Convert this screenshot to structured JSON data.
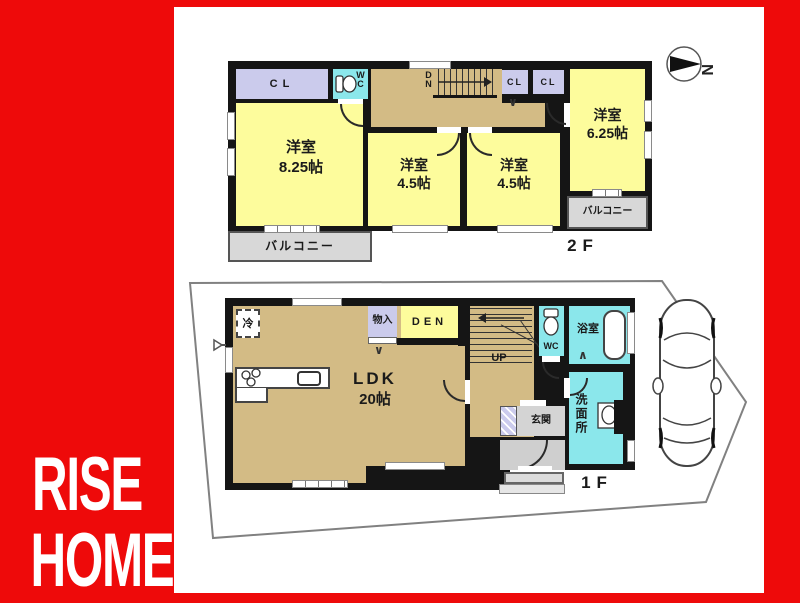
{
  "brand": {
    "line1": "RISE",
    "line2": "HOME",
    "bg_color": "#ee0a0a",
    "text_color": "#ffffff"
  },
  "compass": {
    "north_label": "N"
  },
  "colors": {
    "room_yellow": "#fdfc9c",
    "corridor_tan": "#d3bb85",
    "wet_cyan": "#8be7eb",
    "closet_lavender": "#cbcbec",
    "balcony_gray": "#d8d8d8",
    "wall_black": "#151515"
  },
  "floor2": {
    "label": "2F",
    "closet_left": "CL",
    "closet_mid": "CL",
    "closet_right": "CL",
    "wc": "WC",
    "stairs_down": "DN",
    "room_large": {
      "name": "洋室",
      "size": "8.25帖"
    },
    "room_mid_left": {
      "name": "洋室",
      "size": "4.5帖"
    },
    "room_mid_right": {
      "name": "洋室",
      "size": "4.5帖"
    },
    "room_right": {
      "name": "洋室",
      "size": "6.25帖"
    },
    "balcony_left": "バルコニー",
    "balcony_right": "バルコニー"
  },
  "floor1": {
    "label": "1F",
    "ldk": {
      "name": "LDK",
      "size": "20帖"
    },
    "den": "DEN",
    "storage": "物入",
    "fridge": "冷",
    "stairs_up": "UP",
    "wc": "WC",
    "bath": "浴室",
    "washroom": "洗面所",
    "entrance": "玄関"
  },
  "marks": {
    "fold_down": "∨",
    "fold_up": "∧"
  }
}
